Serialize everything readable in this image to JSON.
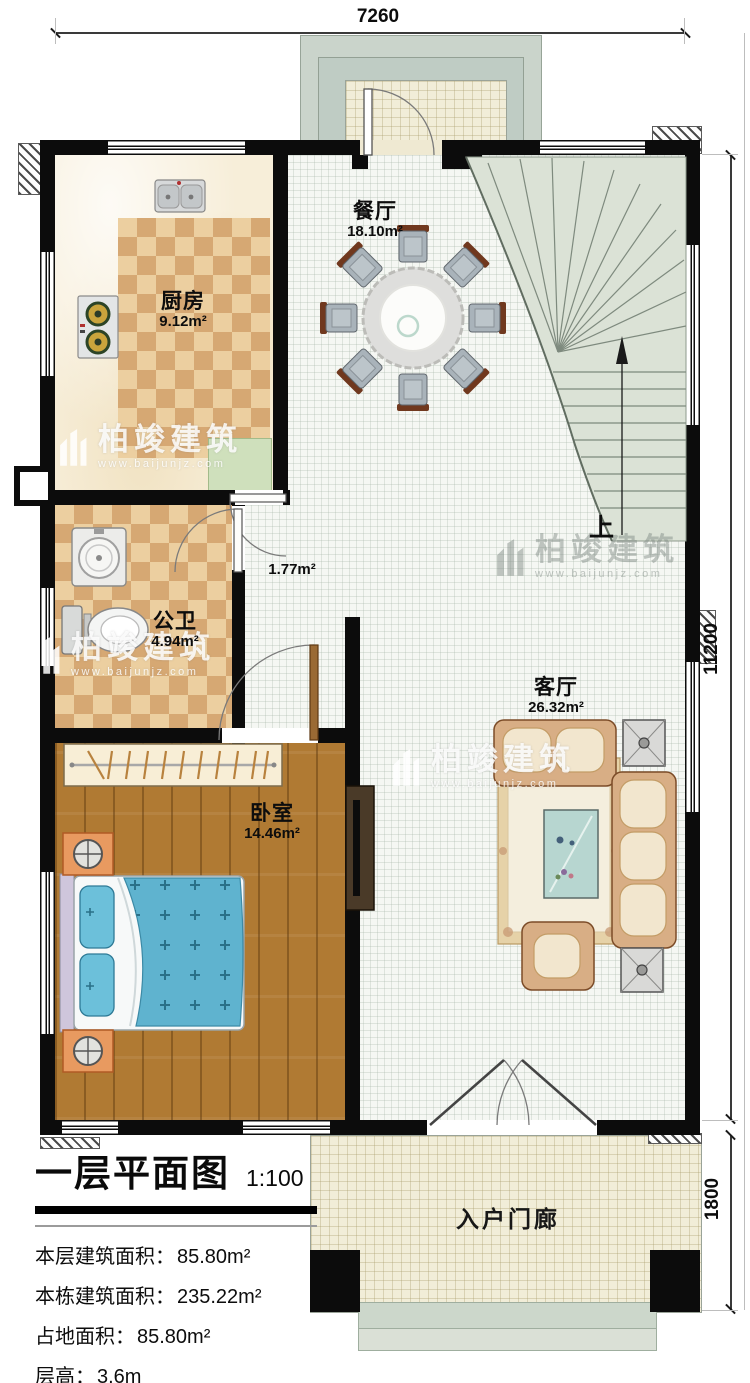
{
  "dimensions": {
    "top": "7260",
    "right": "11200",
    "porch_right": "1800"
  },
  "rooms": {
    "dining": {
      "name": "餐厅",
      "area": "18.10m²"
    },
    "kitchen": {
      "name": "厨房",
      "area": "9.12m²"
    },
    "corridor": {
      "area": "1.77m²"
    },
    "bathroom": {
      "name": "公卫",
      "area": "4.94m²"
    },
    "bedroom": {
      "name": "卧室",
      "area": "14.46m²"
    },
    "living": {
      "name": "客厅",
      "area": "26.32m²"
    },
    "entry_porch": {
      "name": "入户门廊"
    }
  },
  "stairs": {
    "up": "上"
  },
  "title_block": {
    "title": "一层平面图",
    "scale": "1:100",
    "rows": [
      {
        "label": "本层建筑面积：",
        "value": "85.80m²"
      },
      {
        "label": "本栋建筑面积：",
        "value": "235.22m²"
      },
      {
        "label": "占地面积：",
        "value": "85.80m²"
      },
      {
        "label": "层高：",
        "value": "3.6m"
      }
    ]
  },
  "watermark": {
    "brand": "柏竣建筑",
    "url": "www.baijunjz.com"
  },
  "colors": {
    "wall": "#0c0c0c",
    "stairs": "#dbe2d6",
    "wood": "#b07a33",
    "bed": "#5fb3cf"
  }
}
